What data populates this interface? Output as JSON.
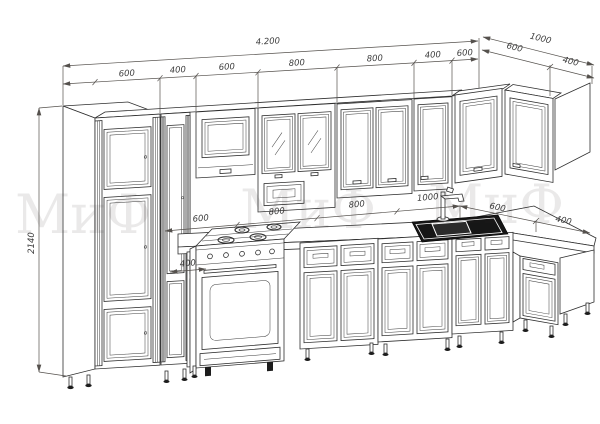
{
  "drawing": {
    "kind": "kitchen-set elevation technical drawing",
    "colors": {
      "line": "#2e2e2e",
      "dim_text": "#3c3c3c",
      "watermark": "rgba(45,40,40,0.10)",
      "background": "#ffffff"
    },
    "watermark": {
      "text1": "МиФ",
      "text2": "МиФ",
      "text3": "МиФ"
    },
    "dims": {
      "total_width": "4.200",
      "right_depth": "1000",
      "height": "2140",
      "top": [
        "600",
        "400",
        "600",
        "800",
        "800",
        "400",
        "600"
      ],
      "top_right": [
        "600",
        "400"
      ],
      "mid": [
        "600",
        "800",
        "800",
        "1000"
      ],
      "mid_right": [
        "600",
        "400"
      ],
      "base_left": "400"
    }
  }
}
